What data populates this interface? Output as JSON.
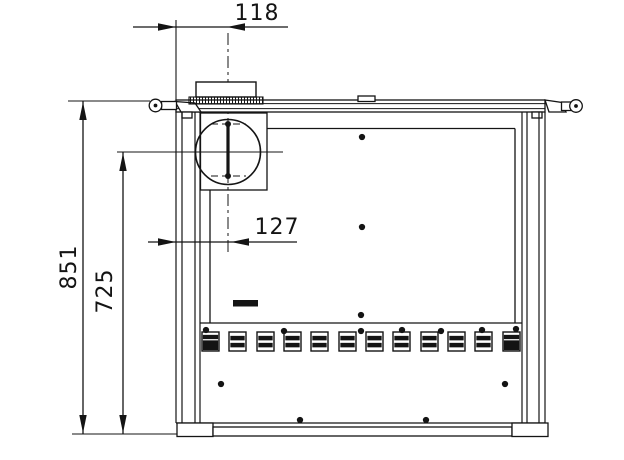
{
  "dimensions": {
    "flue_offset_top": {
      "value": "118",
      "orientation": "horizontal"
    },
    "flue_offset_mid": {
      "value": "127",
      "orientation": "horizontal"
    },
    "overall_height": {
      "value": "851",
      "orientation": "vertical"
    },
    "flue_center_height": {
      "value": "725",
      "orientation": "vertical"
    }
  },
  "vents": {
    "count": 12,
    "slot_xs": [
      202,
      229,
      257,
      284,
      311,
      339,
      366,
      393,
      421,
      448,
      475,
      503
    ],
    "y": 332,
    "width": 17,
    "height": 19,
    "solid_slots": [
      0,
      11
    ]
  },
  "screws": {
    "panel": [
      [
        362,
        137
      ],
      [
        362,
        227
      ],
      [
        361,
        315
      ]
    ],
    "vent_row": [
      [
        206,
        330
      ],
      [
        284,
        331
      ],
      [
        361,
        331
      ],
      [
        402,
        330
      ],
      [
        441,
        331
      ],
      [
        482,
        330
      ],
      [
        516,
        329
      ]
    ],
    "lower": [
      [
        221,
        384
      ],
      [
        505,
        384
      ],
      [
        300,
        420
      ],
      [
        426,
        420
      ]
    ]
  },
  "colors": {
    "line_color": "#141414",
    "background": "#ffffff"
  }
}
